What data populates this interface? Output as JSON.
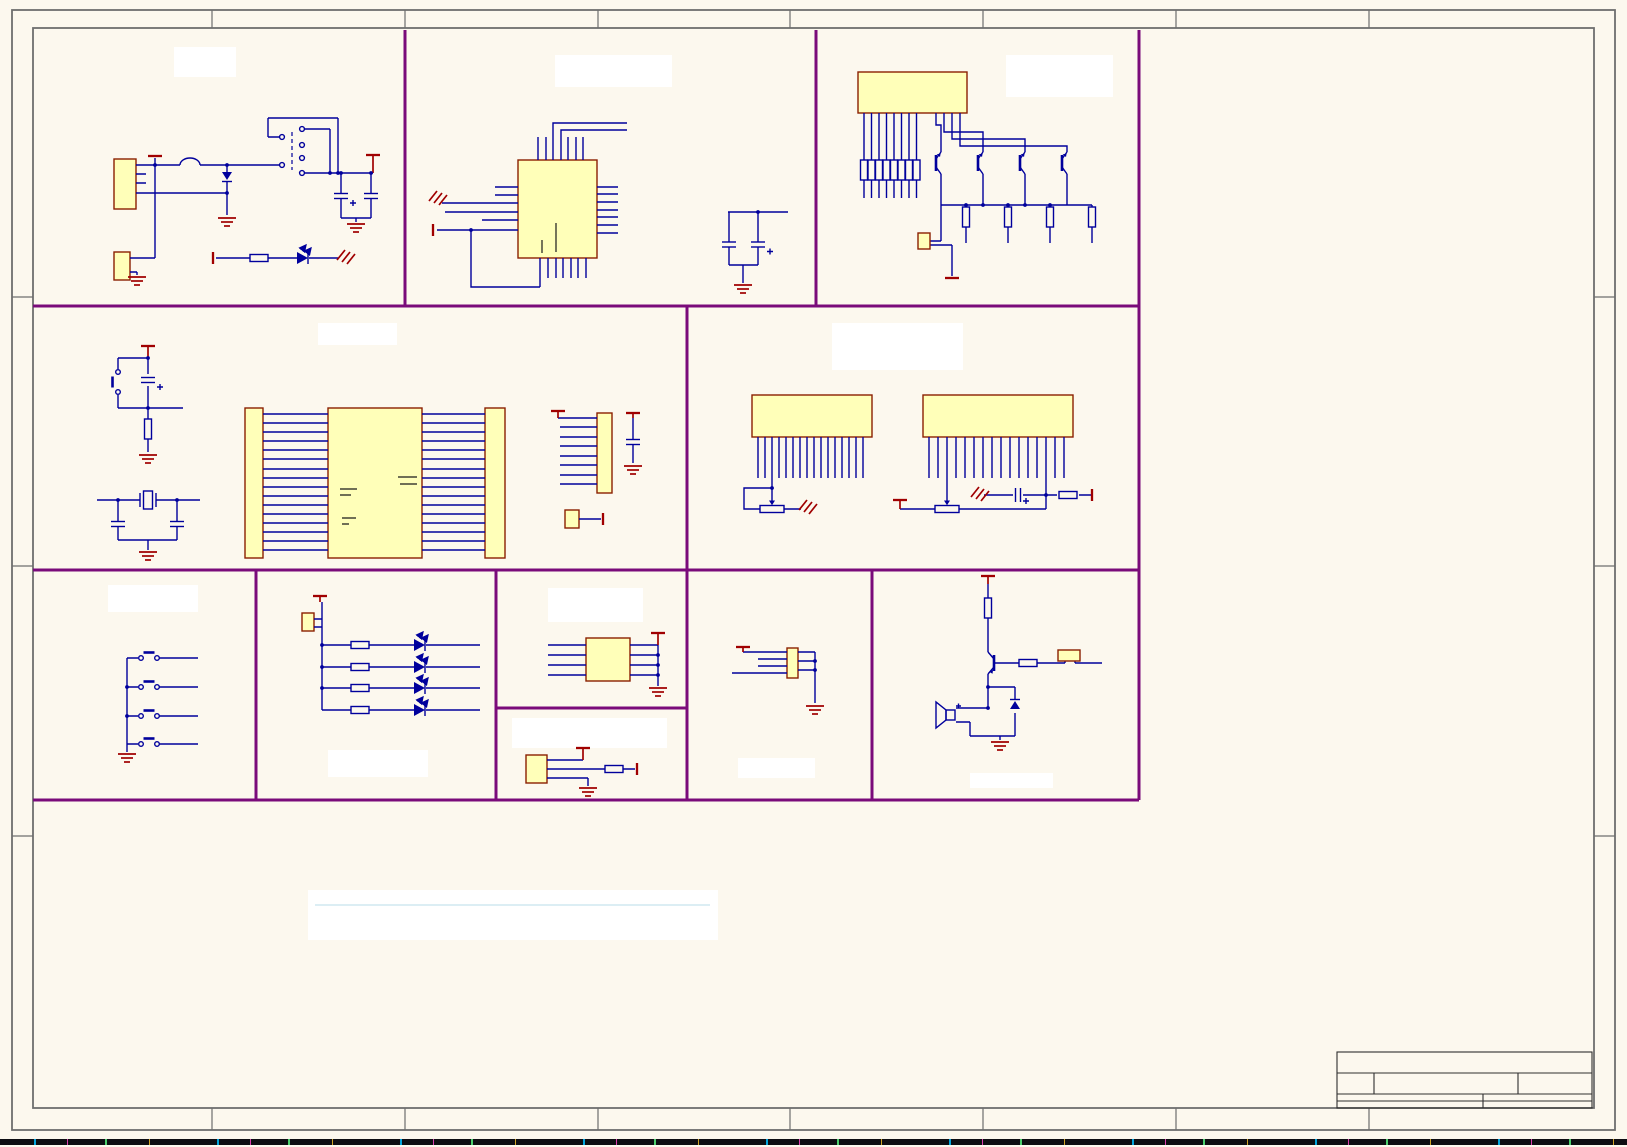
{
  "document": {
    "kind": "circuit-schematic-sheet",
    "visible_text": [],
    "notes_area_text": ""
  },
  "colors": {
    "canvas": "#FCF8EE",
    "component_fill": "#FFFFB9",
    "component_outline": "#8B2000",
    "wire": "#00009C",
    "power_symbol": "#A00000",
    "partition": "#7A0B7A",
    "frame": "#6E6E6E",
    "label_box": "#FFFFFF",
    "title_lines": "#2F2F2F",
    "noise_strip": "#0D0D12"
  },
  "sections": [
    {
      "id": "power-input",
      "label_text": "",
      "parts": {
        "connectors": 2,
        "switch": 1,
        "diode": 1,
        "fuse": 1,
        "capacitors": 2,
        "led": 1,
        "resistor": 1
      }
    },
    {
      "id": "controller-ic",
      "label_text": "",
      "parts": {
        "ic": 1,
        "capacitors": 2
      }
    },
    {
      "id": "segment-driver",
      "label_text": "",
      "parts": {
        "connector": 1,
        "resistors": 12,
        "transistors": 4
      }
    },
    {
      "id": "mcu-core",
      "label_text": "",
      "parts": {
        "push_button": 1,
        "crystal": 1,
        "capacitors": 4,
        "headers": 3,
        "main_ic": 1
      }
    },
    {
      "id": "lcd-headers",
      "label_text": "",
      "parts": {
        "headers": 2,
        "potentiometers": 2,
        "capacitor": 1,
        "resistor": 1
      }
    },
    {
      "id": "keypad",
      "label_text": "",
      "parts": {
        "buttons": 4
      }
    },
    {
      "id": "indicator-leds",
      "label_text": "",
      "parts": {
        "leds": 4,
        "resistors": 4,
        "jumper": 1
      }
    },
    {
      "id": "interface-ic",
      "label_text": "",
      "parts": {
        "ic": 1
      }
    },
    {
      "id": "sensor",
      "label_text": "",
      "parts": {
        "component": 1,
        "resistor": 1
      }
    },
    {
      "id": "aux-connector",
      "label_text": "",
      "parts": {
        "connector": 1
      }
    },
    {
      "id": "buzzer-driver",
      "label_text": "",
      "parts": {
        "speaker": 1,
        "transistor": 1,
        "diode": 1,
        "resistors": 2
      }
    },
    {
      "id": "notes-area",
      "label_text": ""
    },
    {
      "id": "title-block",
      "cells": [
        "",
        "",
        "",
        "",
        "",
        ""
      ]
    }
  ]
}
